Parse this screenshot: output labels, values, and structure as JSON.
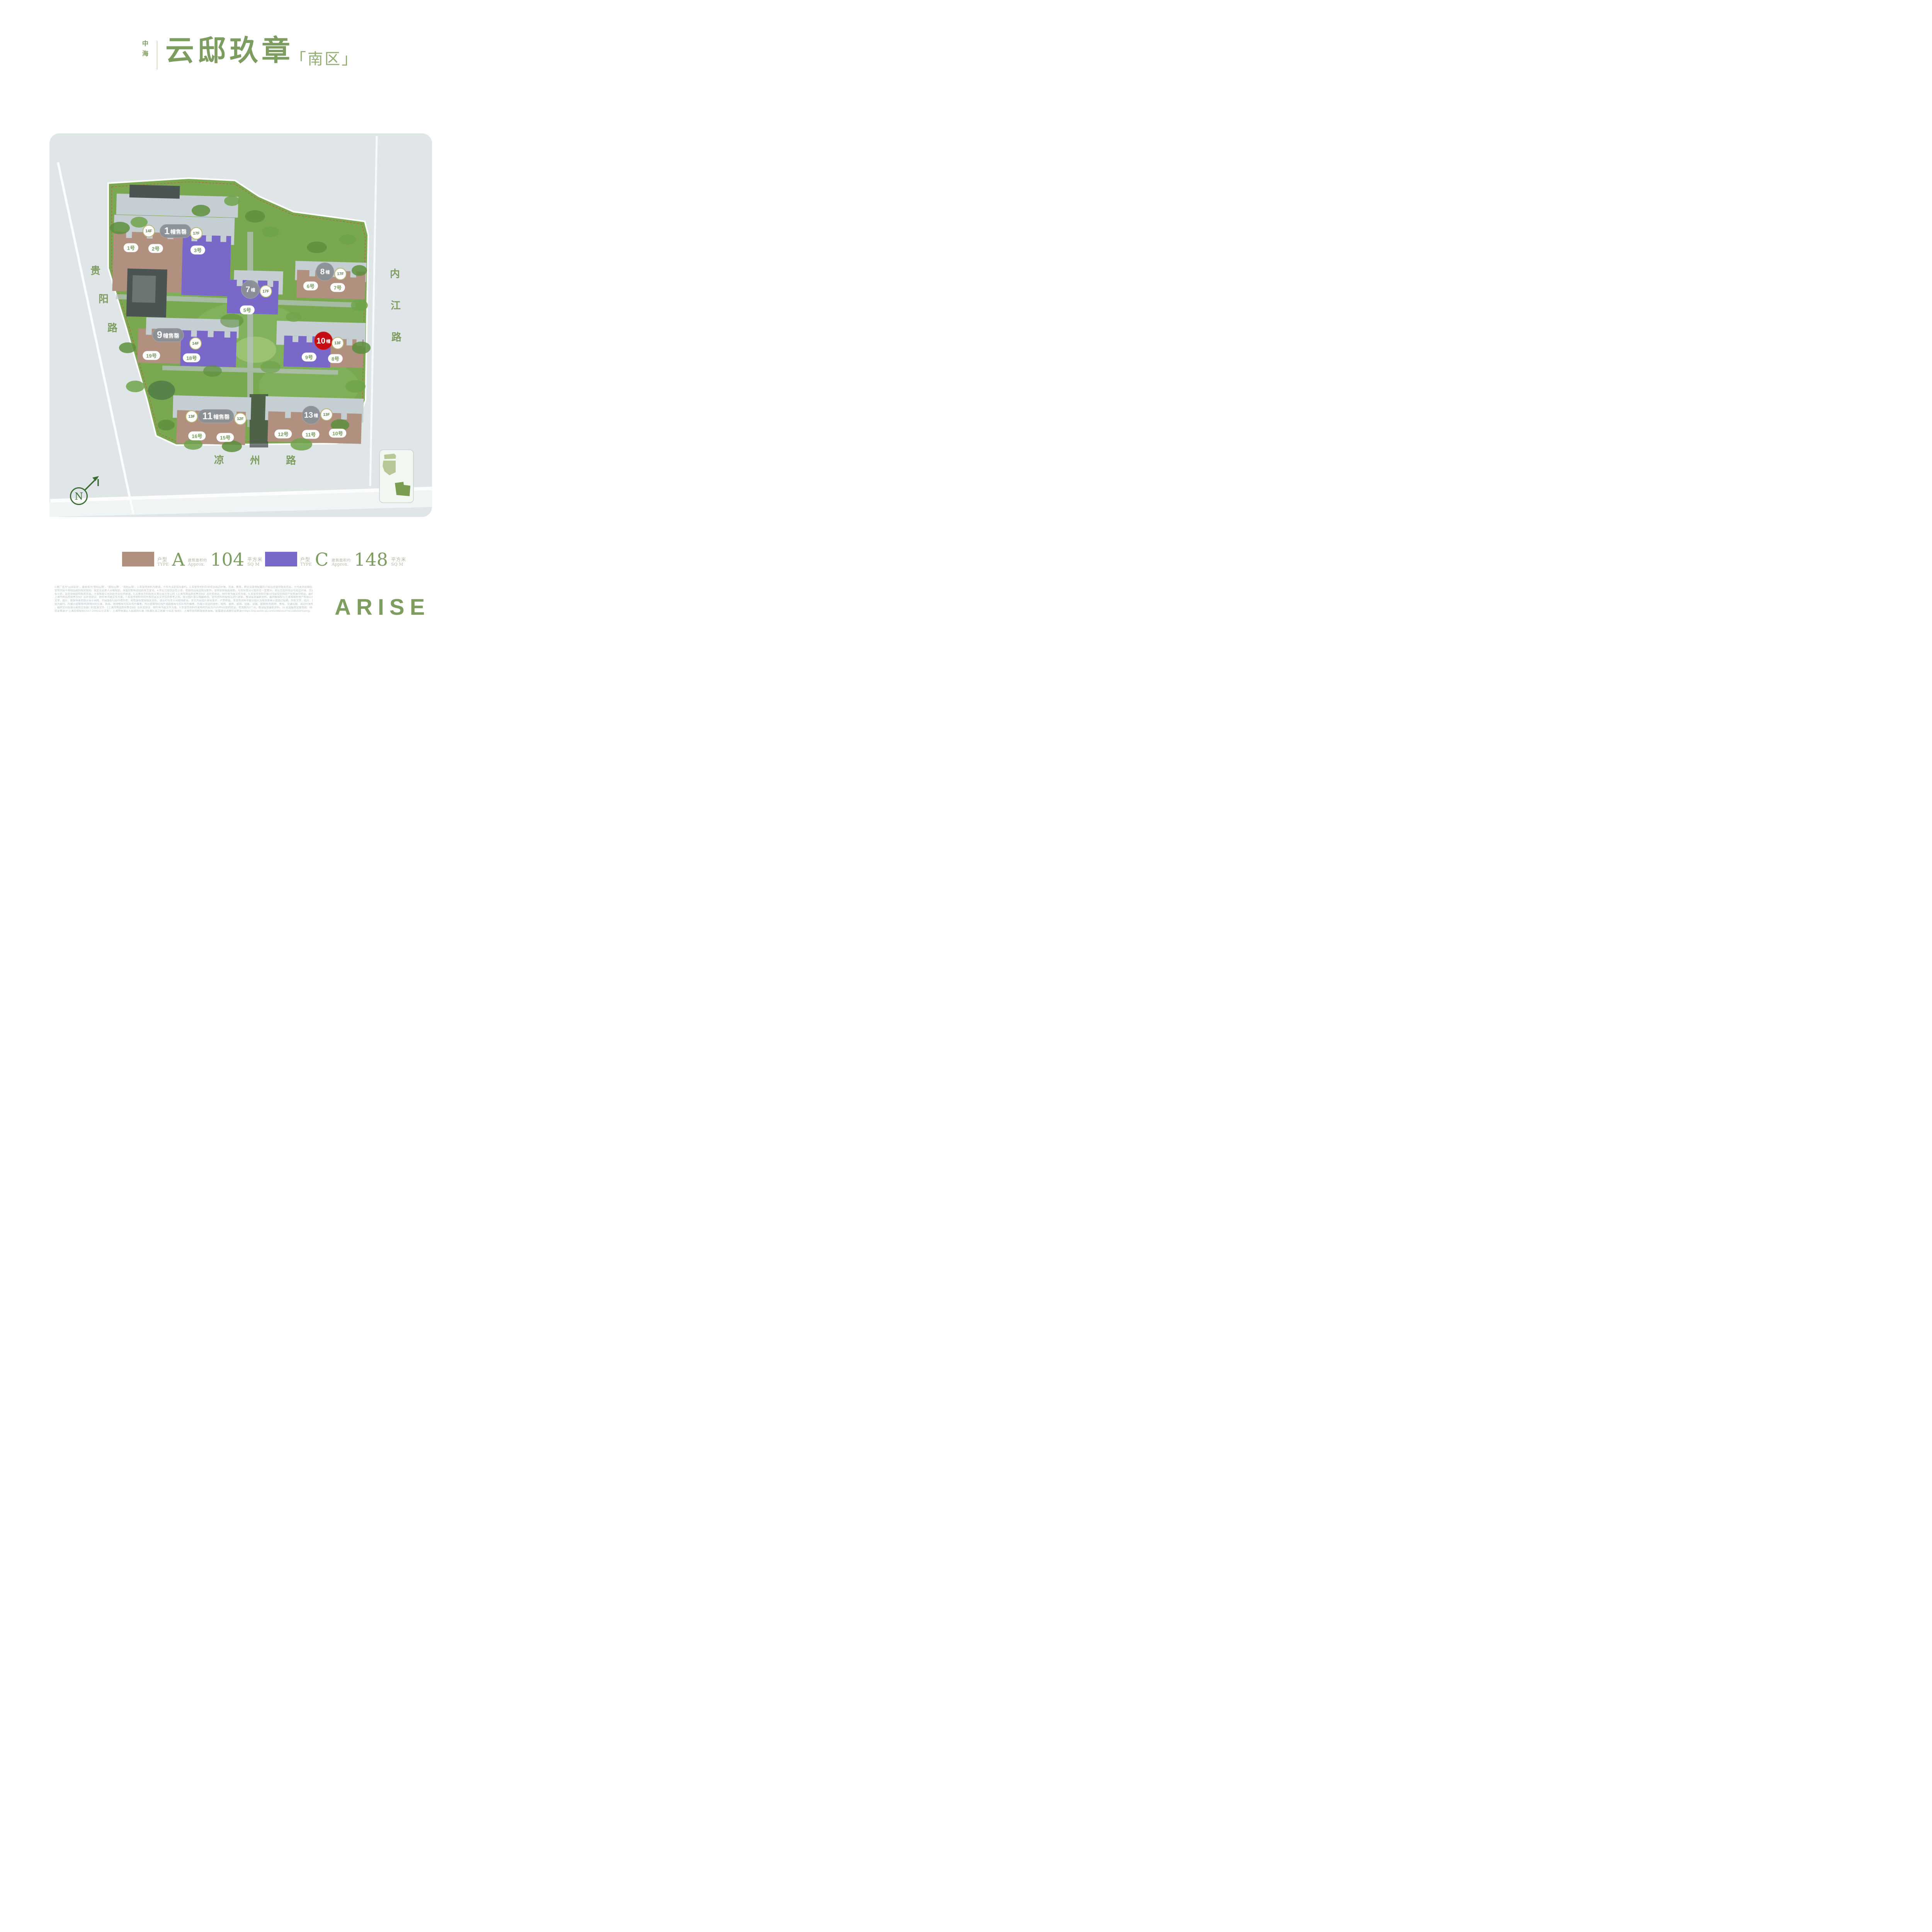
{
  "title": {
    "brand": "中海",
    "name": "云邸玖章",
    "district_bracketed": "「南区」"
  },
  "map": {
    "north_label": "N",
    "roads": [
      {
        "id": "guiyang",
        "name": "贵阳路"
      },
      {
        "id": "neijiang",
        "name": "内江路"
      },
      {
        "id": "liangzhou",
        "name": "凉州路"
      }
    ],
    "buildings": [
      {
        "id": "1",
        "name": "1幢售罄",
        "shape": "pill",
        "sold_out": true,
        "highlight": false,
        "floors": [
          "14F",
          "17F"
        ],
        "units": [
          {
            "label": "1号",
            "type": "A"
          },
          {
            "label": "2号",
            "type": "A"
          },
          {
            "label": "3号",
            "type": "C"
          }
        ]
      },
      {
        "id": "7",
        "name": "7幢",
        "shape": "circle",
        "sold_out": false,
        "highlight": false,
        "floors": [
          "17F"
        ],
        "units": [
          {
            "label": "5号",
            "type": "C"
          }
        ]
      },
      {
        "id": "8",
        "name": "8幢",
        "shape": "circle",
        "sold_out": false,
        "highlight": false,
        "floors": [
          "17F"
        ],
        "units": [
          {
            "label": "6号",
            "type": "A"
          },
          {
            "label": "7号",
            "type": "A"
          }
        ]
      },
      {
        "id": "9",
        "name": "9幢售罄",
        "shape": "pill",
        "sold_out": true,
        "highlight": false,
        "floors": [
          "14F"
        ],
        "units": [
          {
            "label": "19号",
            "type": "A"
          },
          {
            "label": "18号",
            "type": "C"
          }
        ]
      },
      {
        "id": "10",
        "name": "10幢",
        "shape": "circle",
        "sold_out": false,
        "highlight": true,
        "floors": [
          "13F"
        ],
        "units": [
          {
            "label": "9号",
            "type": "C"
          },
          {
            "label": "8号",
            "type": "A"
          }
        ]
      },
      {
        "id": "11",
        "name": "11幢售罄",
        "shape": "pill",
        "sold_out": true,
        "highlight": false,
        "floors": [
          "13F",
          "12F"
        ],
        "units": [
          {
            "label": "16号",
            "type": "A"
          },
          {
            "label": "15号",
            "type": "A"
          }
        ]
      },
      {
        "id": "13",
        "name": "13幢",
        "shape": "circle",
        "sold_out": false,
        "highlight": false,
        "floors": [
          "13F"
        ],
        "units": [
          {
            "label": "12号",
            "type": "A"
          },
          {
            "label": "11号",
            "type": "A"
          },
          {
            "label": "10号",
            "type": "A"
          }
        ]
      }
    ]
  },
  "legend": {
    "items": [
      {
        "type_label": "户型",
        "type_en": "TYPE",
        "type_code": "A",
        "area_label": "建筑面积约",
        "area_en": "Approx.",
        "area_value": "104",
        "unit_label": "平方米",
        "unit_en": "SQ M",
        "color": "#b1907f"
      },
      {
        "type_label": "户型",
        "type_en": "TYPE",
        "type_code": "C",
        "area_label": "建筑面积约",
        "area_en": "Approx.",
        "area_value": "148",
        "unit_label": "平方米",
        "unit_en": "SQ M",
        "color": "#7a68c8"
      }
    ]
  },
  "footer": {
    "logo": "ARISE",
    "disclaimer_lines": [
      "1.推广名为“云邸玖章”，备案名为“悦阳云筑”、“波阳云筑”、“浩阳云筑”。2.本宣传资料为邀请，不作为法定实际要约。3.本宣传资料中对项目周边环境、交通、教育、商业及其他配套的介绍旨在提供相关信息，不代表对此做出了要约或承诺；相关",
      "宣传内容不排除因政府相关规划、规定及出卖人分期规划、未能控制等原因而发生变化。4.本区位图仅旨在示意，依据项目周边情况制作，受材质和幅面限制，与实际情况可能存在一定差异。本区位图对项目与周边环境、交通、公共设施的地理关",
      "系示意，旨在协助提供相关信息，不意味着公司对此作出任何承诺。5.买卖双方的权利义务以双方签订的《上海市商品房预售合同》及补充协议、附件等书面文件为准。6.本宣传资料中部分内容仅在特定户型房源中体现，最终交付以双方签订的《",
      "上海市商品房预售合同》及补充协议、附件等书面文件为准。7.本宣传材料中的所有信息及文字仅供参考之用，部分图片曾以电脑修改，宣传资料将视情况进行更新，敬请留意最新资料，最终解释权归上海海瑧房地产有限公司。8.本宣传资料中",
      "文字、图片、数据等素材部分源于网络，内容版权归原作者所有；如有版权使用相关责权，请及时与本公司取得联系。本文内容图片未经准许，严禁转载。本宣传资料中部分图片为规划效果示意图过程稿，所有文字、图片、数据信息等仅供参考，不",
      "视为要约。所展示建筑物/构筑物间的位置、距离、地理格局与实际有所偏差。所示建筑物红线外道路格局与实际有所偏差、所展示项目的面积、结构、装修、装饰、设备、设施、建筑物/构筑物、景观、交通设施、周边环境等仅供参考，不构成交付标准",
      "，最终交付标准以政府主管部门的批准文件、《上海市商品房预售合同》及补充协议、附件等书面文件为准。9.本宣传资料所发布的内容为2025年6月前的信息，有效期为3个月，敬请留意最新资料。10.全国服务监督热线：95112。11.杨浦滨江规划",
      "信息来源于“上海总体规划(2017-2035)公示文本”、上海市杨浦区人民政府印发《杨浦区滨江发展“十四五”规划》、上海市自然和规划资源局。配套建设进度信息来源于https://mp.weixin.qq.com/s/38dvxxzFmC1n8xOoHvqnxg。"
    ]
  },
  "colors": {
    "accent_green": "#7d9c60",
    "title_district": "#93ad74",
    "type_a": "#b1907f",
    "type_c": "#7a68c8",
    "building_gray": "#c5ced2",
    "building_dark": "#4a5553",
    "sold_pill_gray": "#8b9196",
    "highlight_red": "#c50e13",
    "badge_border": "#b9b873",
    "badge_text": "#5d7c49",
    "unit_text": "#7b9b63",
    "road_bg": "#e0e6e7",
    "site_green": "#79a851",
    "site_green_light": "#8ab964",
    "tree_green": "#5d8f3d",
    "north_green": "#3c6b34",
    "inset_light": "#b7c795",
    "inset_dark": "#7a9b51",
    "disclaimer_gray": "#b7c2c6",
    "logo_green": "#7d9e5e"
  }
}
